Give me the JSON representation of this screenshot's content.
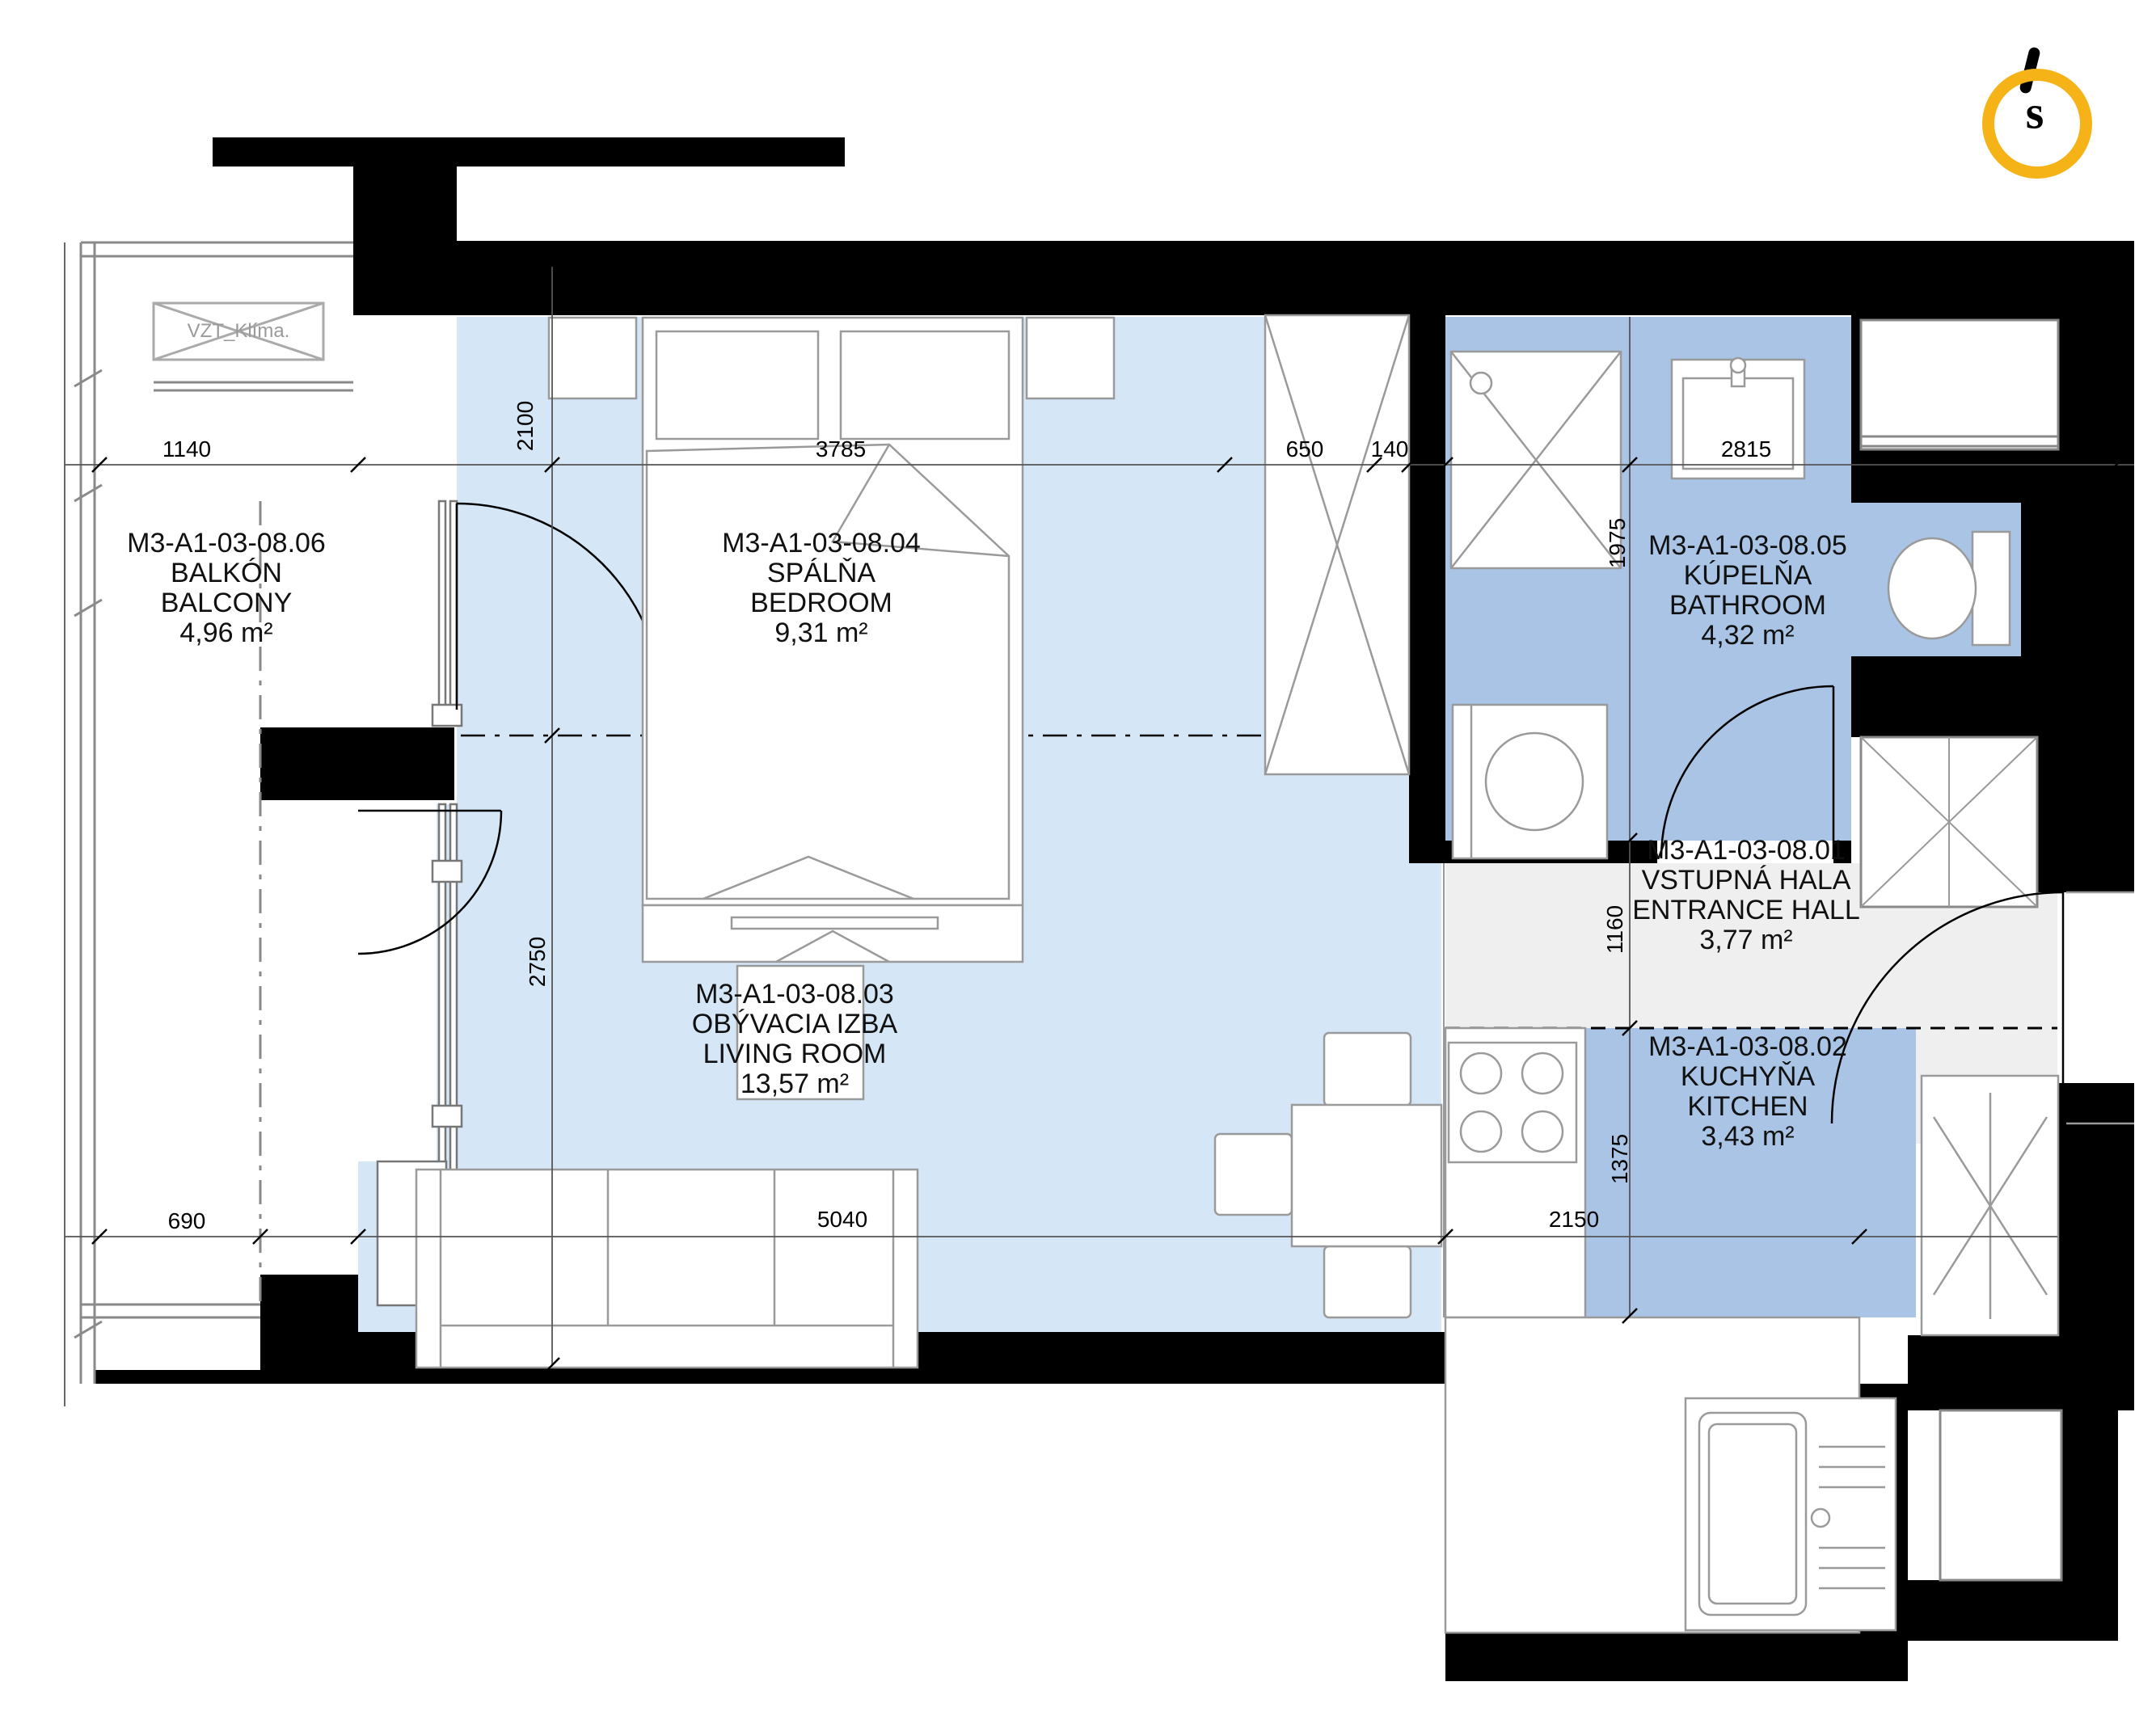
{
  "logo": {
    "letter": "s",
    "ring_color": "#F6B318"
  },
  "rooms": {
    "balcony": {
      "code": "M3-A1-03-08.06",
      "name_sk": "BALKÓN",
      "name_en": "BALCONY",
      "area": "4,96 m²"
    },
    "bedroom": {
      "code": "M3-A1-03-08.04",
      "name_sk": "SPÁLŇA",
      "name_en": "BEDROOM",
      "area": "9,31 m²"
    },
    "living": {
      "code": "M3-A1-03-08.03",
      "name_sk": "OBÝVACIA IZBA",
      "name_en": "LIVING ROOM",
      "area": "13,57 m²"
    },
    "bathroom": {
      "code": "M3-A1-03-08.05",
      "name_sk": "KÚPELŇA",
      "name_en": "BATHROOM",
      "area": "4,32 m²"
    },
    "hall": {
      "code": "M3-A1-03-08.01",
      "name_sk": "VSTUPNÁ HALA",
      "name_en": "ENTRANCE HALL",
      "area": "3,77 m²"
    },
    "kitchen": {
      "code": "M3-A1-03-08.02",
      "name_sk": "KUCHYŇA",
      "name_en": "KITCHEN",
      "area": "3,43 m²"
    }
  },
  "dimensions": {
    "top": [
      "1140",
      "3785",
      "650",
      "140",
      "2815"
    ],
    "bottom": [
      "690",
      "5040",
      "2150"
    ],
    "left": [
      "2100",
      "2750"
    ],
    "right": [
      "1975",
      "1160",
      "1375"
    ]
  },
  "annotations": {
    "ac_unit": "VZT_Klíma."
  },
  "colors": {
    "room_light": "#d5e6f7",
    "room_medium": "#a9c4e5",
    "hall_gray": "#efefef",
    "wall": "#000000",
    "furniture_stroke": "#9a9a9a"
  }
}
